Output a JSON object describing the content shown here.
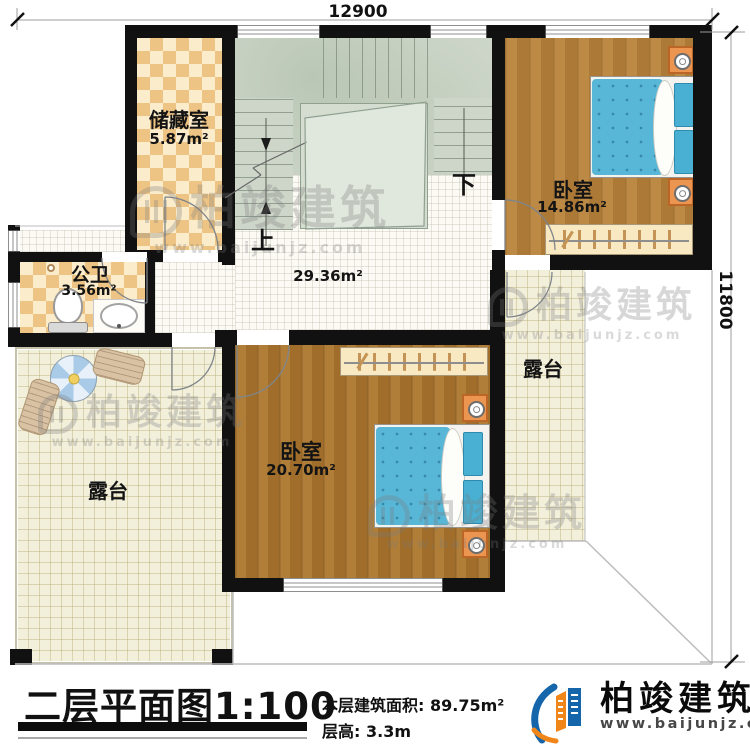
{
  "dimensions": {
    "top": "12900",
    "right": "11800"
  },
  "rooms": {
    "storage": {
      "name": "储藏室",
      "area": "5.87m²"
    },
    "bathroom": {
      "name": "公卫",
      "area": "3.56m²"
    },
    "bedroom_top": {
      "name": "卧室",
      "area": "14.86m²"
    },
    "bedroom_bottom": {
      "name": "卧室",
      "area": "20.70m²"
    },
    "hall": {
      "area": "29.36m²"
    },
    "terrace_left": {
      "name": "露台"
    },
    "terrace_right": {
      "name": "露台"
    },
    "stairs": {
      "up": "上",
      "down": "下"
    }
  },
  "watermark": {
    "brand": "柏竣建筑",
    "url": "www.baijunjz.com"
  },
  "footer": {
    "title": "二层平面图",
    "scale": "1:100",
    "area_label": "本层建筑面积:",
    "area_value": "89.75m²",
    "height_label": "层高:",
    "height_value": "3.3m",
    "brand": "柏竣建筑",
    "brand_url": "www.baijunjz.com"
  },
  "colors": {
    "wall": "#111111",
    "brand_blue": "#1565ab",
    "brand_orange": "#f08519",
    "bed_blue": "#58b7d7",
    "wood": "#b5813b",
    "checker_tan": "#eec484",
    "stairs_green": "#cdd6c9",
    "terrace_tile": "#f2efdb"
  }
}
